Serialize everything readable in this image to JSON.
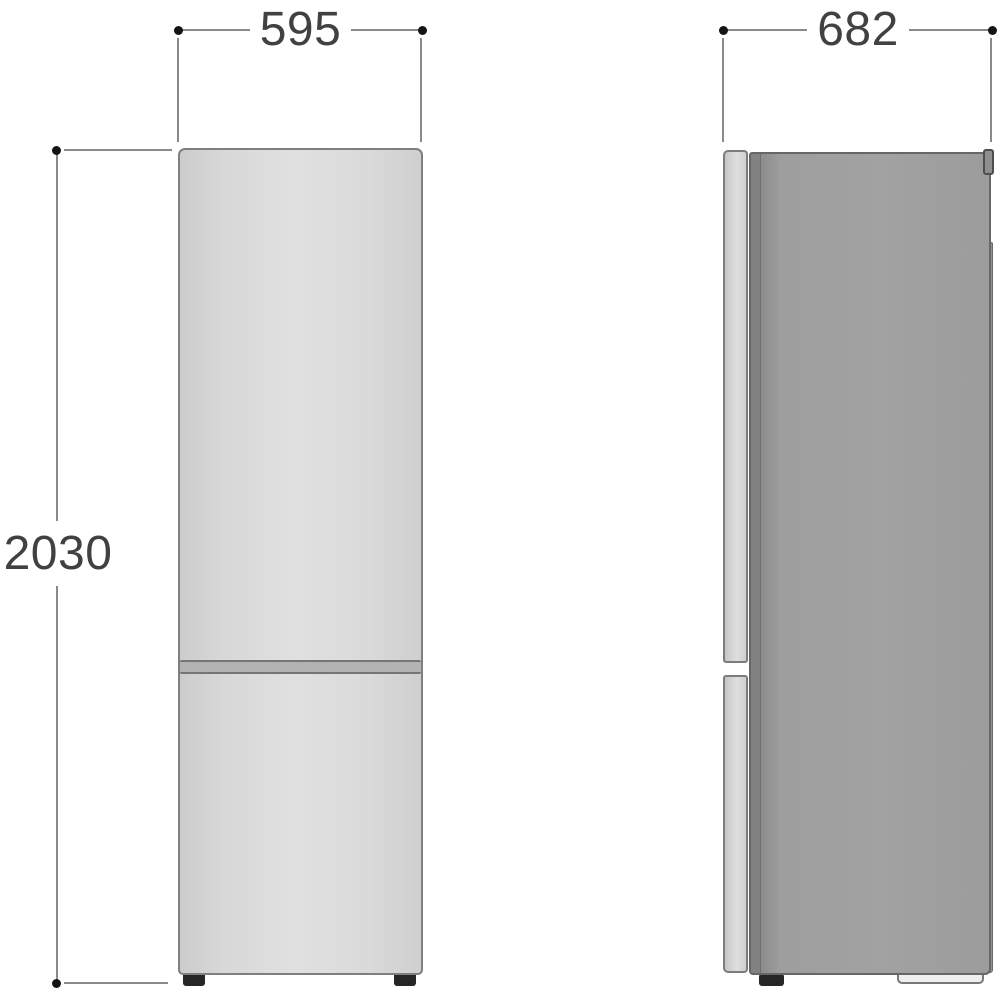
{
  "diagram": {
    "type": "refrigerator-dimension-drawing",
    "views": {
      "front": "front-view",
      "side": "side-view"
    },
    "dimensions": {
      "front_width": "595",
      "height": "2030",
      "side_depth": "682"
    },
    "colors": {
      "dimension_line": "#8a8a8a",
      "dimension_dot": "#141414",
      "dimension_text": "#414141",
      "front_body_fill": "#d9d9d9",
      "front_outline": "#7f7f7f",
      "side_body_fill": "#9e9e9e",
      "side_body_outline": "#676767",
      "side_door_fill": "#d6d6d6",
      "divider_fill": "#b3b3b3",
      "foot_color": "#262626"
    }
  }
}
